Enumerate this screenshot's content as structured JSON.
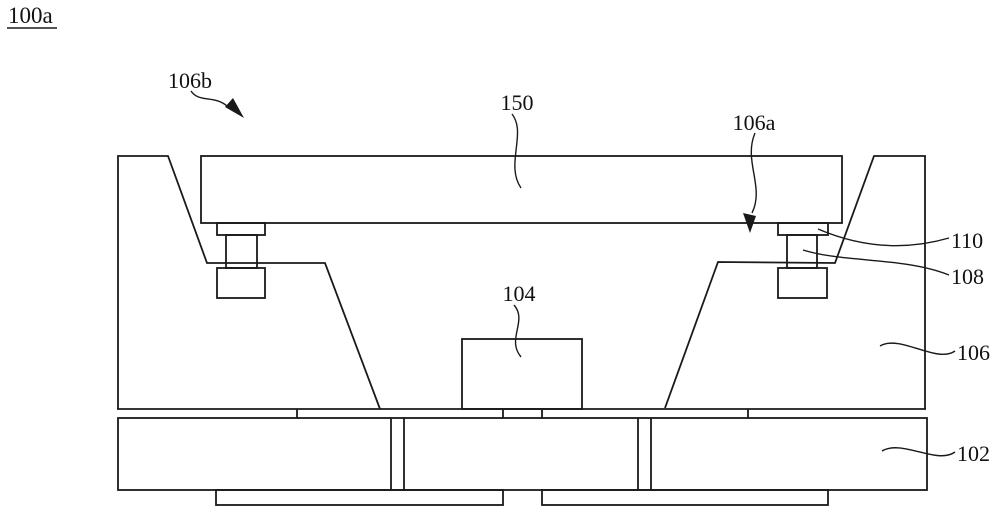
{
  "figure": {
    "background": "#ffffff",
    "line_color": "#1a1a1a",
    "text_color": "#111111"
  },
  "callouts": {
    "c100a": "100a",
    "c106b": "106b",
    "c150": "150",
    "c106a": "106a",
    "c110": "110",
    "c108": "108",
    "c104": "104",
    "c106": "106",
    "c102": "102"
  }
}
